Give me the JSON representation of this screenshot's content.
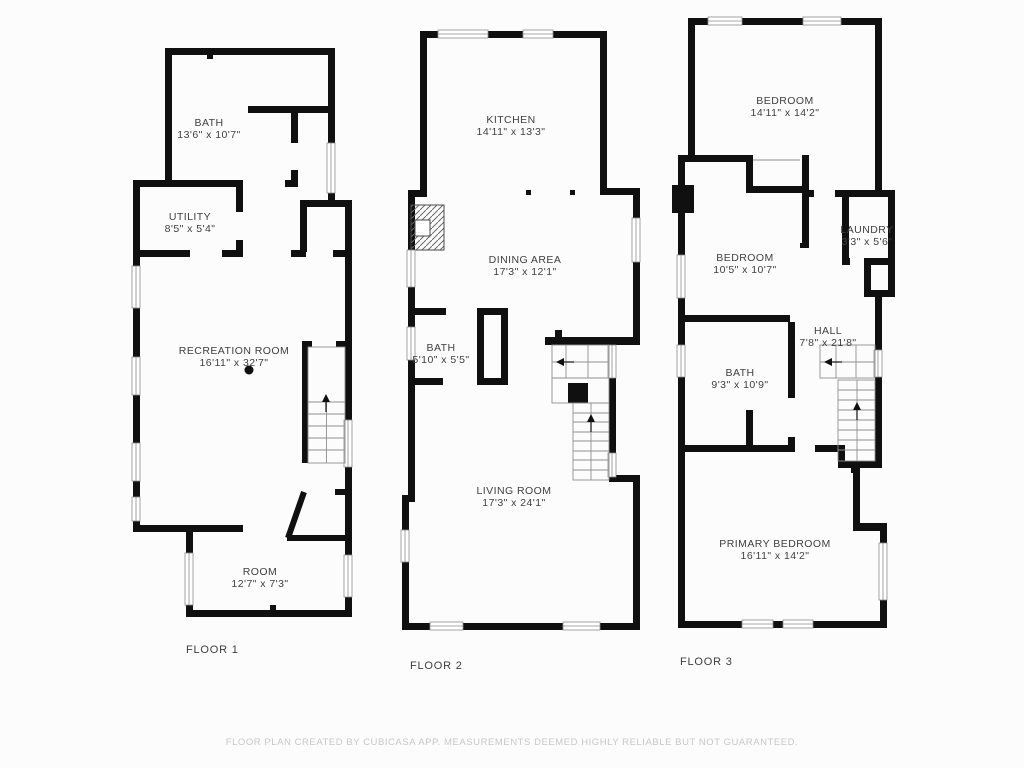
{
  "meta": {
    "type": "floor-plan",
    "floors_count": 3
  },
  "colors": {
    "wall": "#101010",
    "background": "#fcfcfc",
    "room_text": "#3f3f3f",
    "floor_label_text": "#3d3d3d",
    "footer_text": "#c7c7c7",
    "thin_line": "#8c8c8c"
  },
  "floors": [
    {
      "label": "FLOOR 1",
      "rooms": [
        {
          "name": "BATH",
          "dims": "13'6\" x 10'7\""
        },
        {
          "name": "UTILITY",
          "dims": "8'5\" x 5'4\""
        },
        {
          "name": "RECREATION ROOM",
          "dims": "16'11\" x 32'7\""
        },
        {
          "name": "ROOM",
          "dims": "12'7\" x 7'3\""
        }
      ]
    },
    {
      "label": "FLOOR 2",
      "rooms": [
        {
          "name": "KITCHEN",
          "dims": "14'11\" x 13'3\""
        },
        {
          "name": "DINING AREA",
          "dims": "17'3\" x 12'1\""
        },
        {
          "name": "BATH",
          "dims": "5'10\" x 5'5\""
        },
        {
          "name": "LIVING ROOM",
          "dims": "17'3\" x 24'1\""
        }
      ]
    },
    {
      "label": "FLOOR 3",
      "rooms": [
        {
          "name": "BEDROOM",
          "dims": "14'11\" x 14'2\""
        },
        {
          "name": "BEDROOM",
          "dims": "10'5\" x 10'7\""
        },
        {
          "name": "LAUNDRY",
          "dims": "3'3\" x 5'6\""
        },
        {
          "name": "HALL",
          "dims": "7'8\" x 21'8\""
        },
        {
          "name": "BATH",
          "dims": "9'3\" x 10'9\""
        },
        {
          "name": "PRIMARY BEDROOM",
          "dims": "16'11\" x 14'2\""
        }
      ]
    }
  ],
  "footer": {
    "disclaimer": "FLOOR PLAN CREATED BY CUBICASA APP. MEASUREMENTS DEEMED HIGHLY RELIABLE BUT NOT GUARANTEED."
  }
}
